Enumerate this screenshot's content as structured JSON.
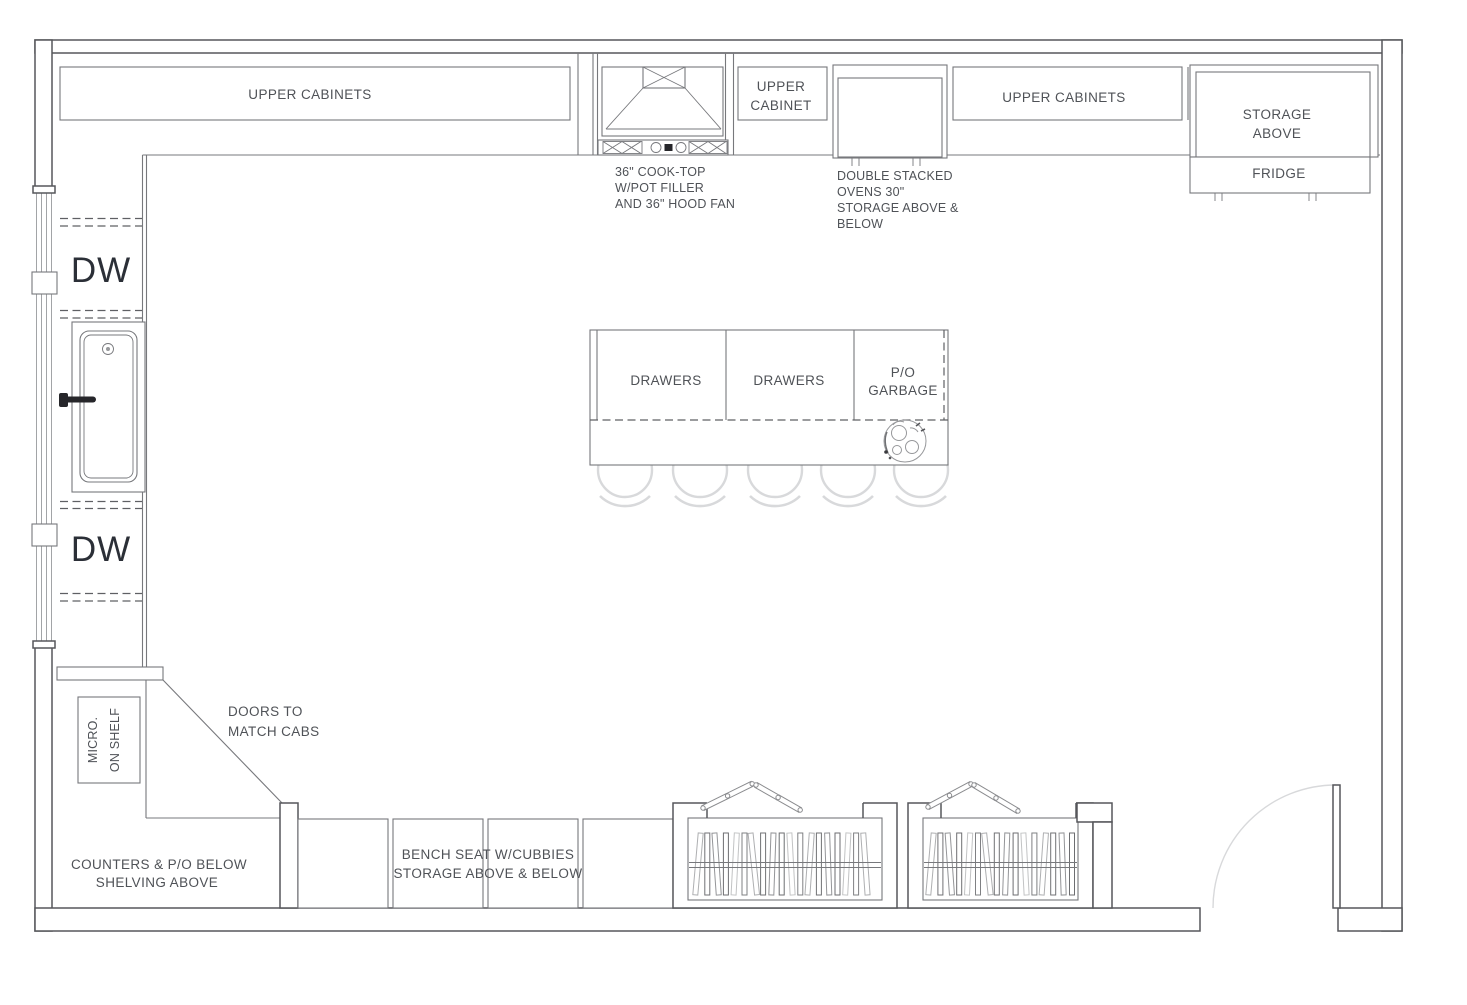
{
  "colors": {
    "wall": "#56575b",
    "cabinet": "#77787c",
    "dashed": "#5f6064",
    "window": "#a2a4a7",
    "light": "#d8d9db",
    "text": "#4f5257",
    "dark_text": "#2b2f37"
  },
  "plan": {
    "top_wall_run": {
      "upper_cabinets_left": "UPPER CABINETS",
      "upper_cabinet_small": [
        "UPPER",
        "CABINET"
      ],
      "upper_cabinets_right": "UPPER CABINETS",
      "cooktop_note": [
        "36\" COOK-TOP",
        "W/POT FILLER",
        "AND 36\" HOOD FAN"
      ],
      "ovens_note": [
        "DOUBLE STACKED",
        "OVENS 30\"",
        "STORAGE ABOVE &",
        "BELOW"
      ],
      "storage_above": [
        "STORAGE",
        "ABOVE"
      ],
      "fridge": "FRIDGE"
    },
    "left_wall_run": {
      "dishwasher_top": "DW",
      "dishwasher_bottom": "DW"
    },
    "island": {
      "drawers_left": "DRAWERS",
      "drawers_right": "DRAWERS",
      "garbage": [
        "P/O",
        "GARBAGE"
      ]
    },
    "bottom_left_corner": {
      "microwave": [
        "MICRO.",
        "ON SHELF"
      ],
      "corner_note": [
        "DOORS TO",
        "MATCH CABS"
      ],
      "counters_note": [
        "COUNTERS & P/O BELOW",
        "SHELVING ABOVE"
      ]
    },
    "bottom_wall_run": {
      "bench_note": [
        "BENCH SEAT W/CUBBIES",
        "STORAGE ABOVE & BELOW"
      ]
    }
  }
}
